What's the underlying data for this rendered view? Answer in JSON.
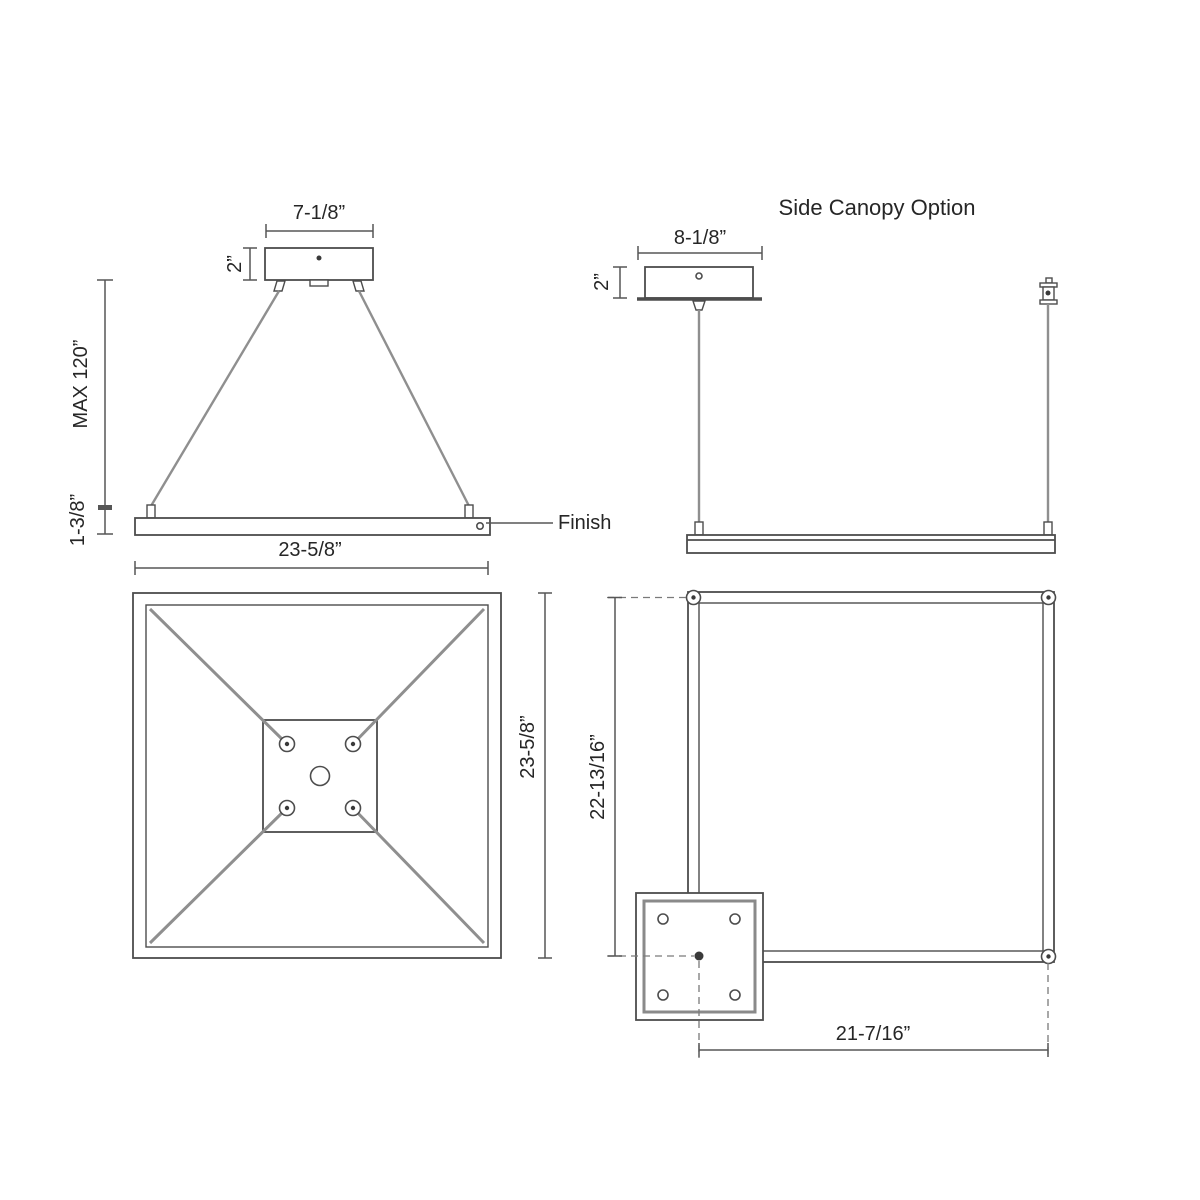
{
  "colors": {
    "background": "#ffffff",
    "line": "#4d4d4d",
    "dimension": "#565656",
    "cable": "#8f8f8f",
    "text": "#262626"
  },
  "front_view": {
    "canopy_width": "7-1/8”",
    "canopy_height": "2”",
    "suspension_max": "MAX 120”",
    "fixture_height": "1-3/8”",
    "fixture_width": "23-5/8”",
    "finish_label": "Finish"
  },
  "side_view": {
    "title": "Side Canopy Option",
    "canopy_width": "8-1/8”",
    "canopy_height": "2”"
  },
  "plan_view": {
    "fixture_width": "23-5/8”"
  },
  "side_plan_view": {
    "height_offset": "22-13/16”",
    "width_offset": "21-7/16”"
  }
}
